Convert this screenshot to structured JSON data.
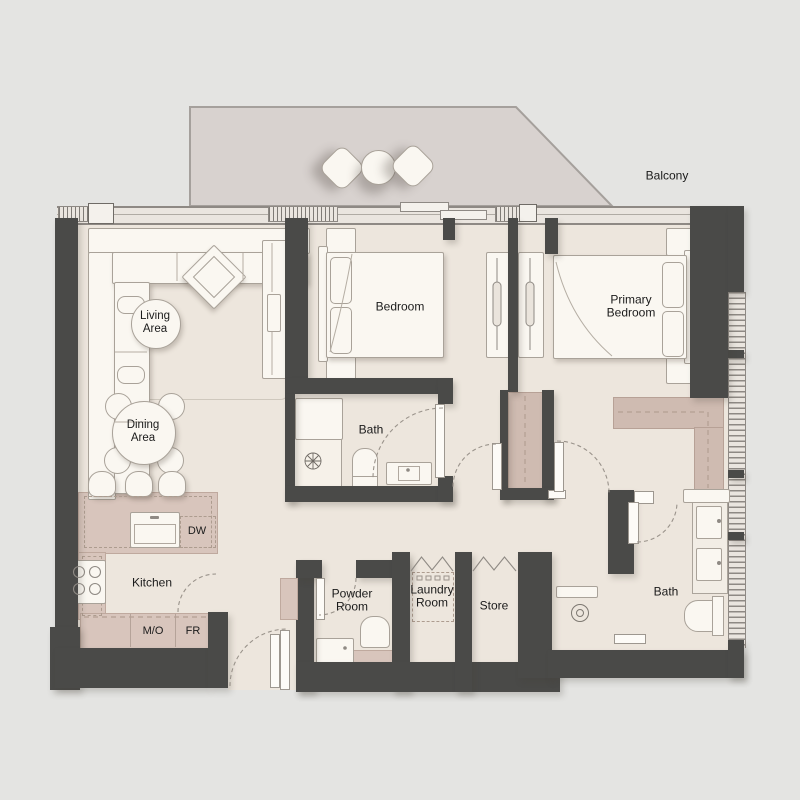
{
  "floor_plan": {
    "rooms": {
      "balcony": "Balcony",
      "living_area": "Living Area",
      "dining_area": "Dining Area",
      "kitchen": "Kitchen",
      "bedroom": "Bedroom",
      "primary_bedroom": "Primary Bedroom",
      "bath": "Bath",
      "ensuite_bath": "Bath",
      "powder_room": "Powder Room",
      "laundry_room": "Laundry Room",
      "store": "Store"
    },
    "appliances": {
      "dishwasher": "DW",
      "microwave_oven": "M/O",
      "fridge": "FR"
    }
  },
  "colors": {
    "bg": "#e4e4e2",
    "wall": "#4a4a48",
    "floor": "#ede6dd",
    "balcony": "#d8d2cf",
    "counter": "#d8c5bc",
    "closet": "#cfbbb1",
    "white": "#faf7f1",
    "line": "#a39d95",
    "dashline": "#ad9c8f",
    "text": "#1b1b1b",
    "band": "#eae5df"
  }
}
